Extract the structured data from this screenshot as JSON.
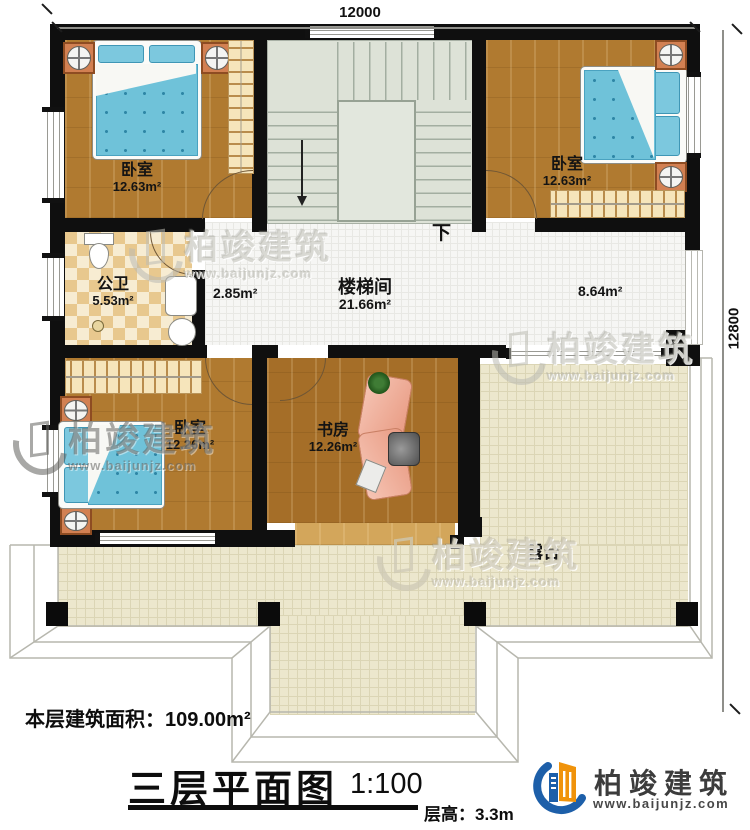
{
  "dimensions": {
    "top": "12000",
    "right": "12800"
  },
  "rooms": {
    "bedroom_tl": {
      "label": "卧室",
      "area": "12.63m²"
    },
    "bedroom_tr": {
      "label": "卧室",
      "area": "12.63m²"
    },
    "bathroom": {
      "label": "公卫",
      "area": "5.53m²"
    },
    "stair_hall": {
      "label": "楼梯间",
      "area": "21.66m²"
    },
    "corridor_area": "2.85m²",
    "hall_area": "8.64m²",
    "bedroom_bl": {
      "label": "卧室",
      "area": "12.26m²"
    },
    "study": {
      "label": "书房",
      "area": "12.26m²"
    },
    "terrace": {
      "label": "露台"
    },
    "stairs_direction": "下"
  },
  "footer": {
    "building_area": "本层建筑面积：109.00m²",
    "title": "三层平面图",
    "scale": "1:100",
    "floor_height": "层高：3.3m"
  },
  "brand": {
    "name": "柏竣建筑",
    "url": "www.baijunjz.com"
  },
  "watermark": {
    "name": "柏竣建筑",
    "url": "www.baijunjz.com"
  }
}
